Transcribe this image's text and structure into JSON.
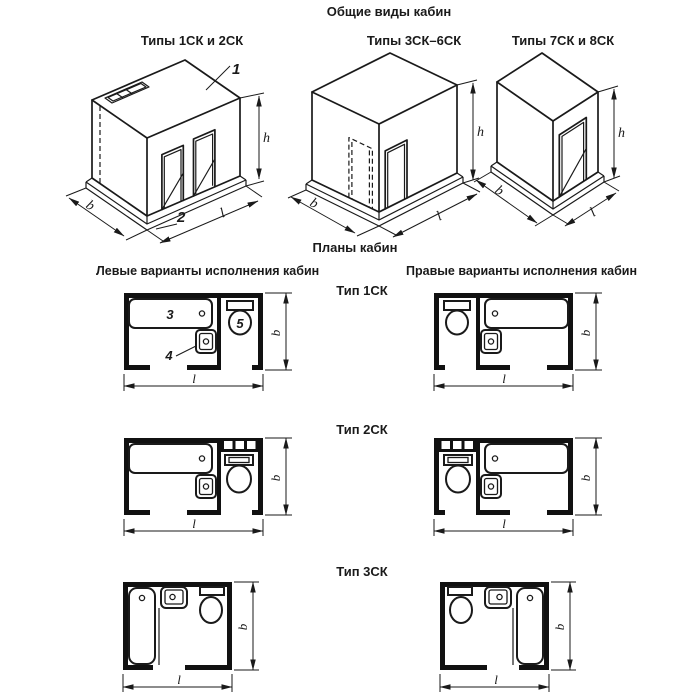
{
  "header": {
    "title": "Общие виды кабин"
  },
  "iso": {
    "v1": {
      "label": "Типы 1СК и 2СК",
      "callout_roof": "1",
      "callout_base": "2"
    },
    "v2": {
      "label": "Типы 3СК–6СК"
    },
    "v3": {
      "label": "Типы 7СК и 8СК"
    }
  },
  "plans": {
    "title": "Планы кабин",
    "col_left": "Левые варианты исполнения кабин",
    "col_right": "Правые варианты исполнения кабин",
    "row1": {
      "label": "Тип 1СК",
      "callout_bath": "3",
      "callout_sink": "4",
      "callout_wc": "5"
    },
    "row2": {
      "label": "Тип 2СК"
    },
    "row3": {
      "label": "Тип 3СК"
    }
  },
  "dims": {
    "width": "b",
    "length": "l",
    "height": "h"
  }
}
